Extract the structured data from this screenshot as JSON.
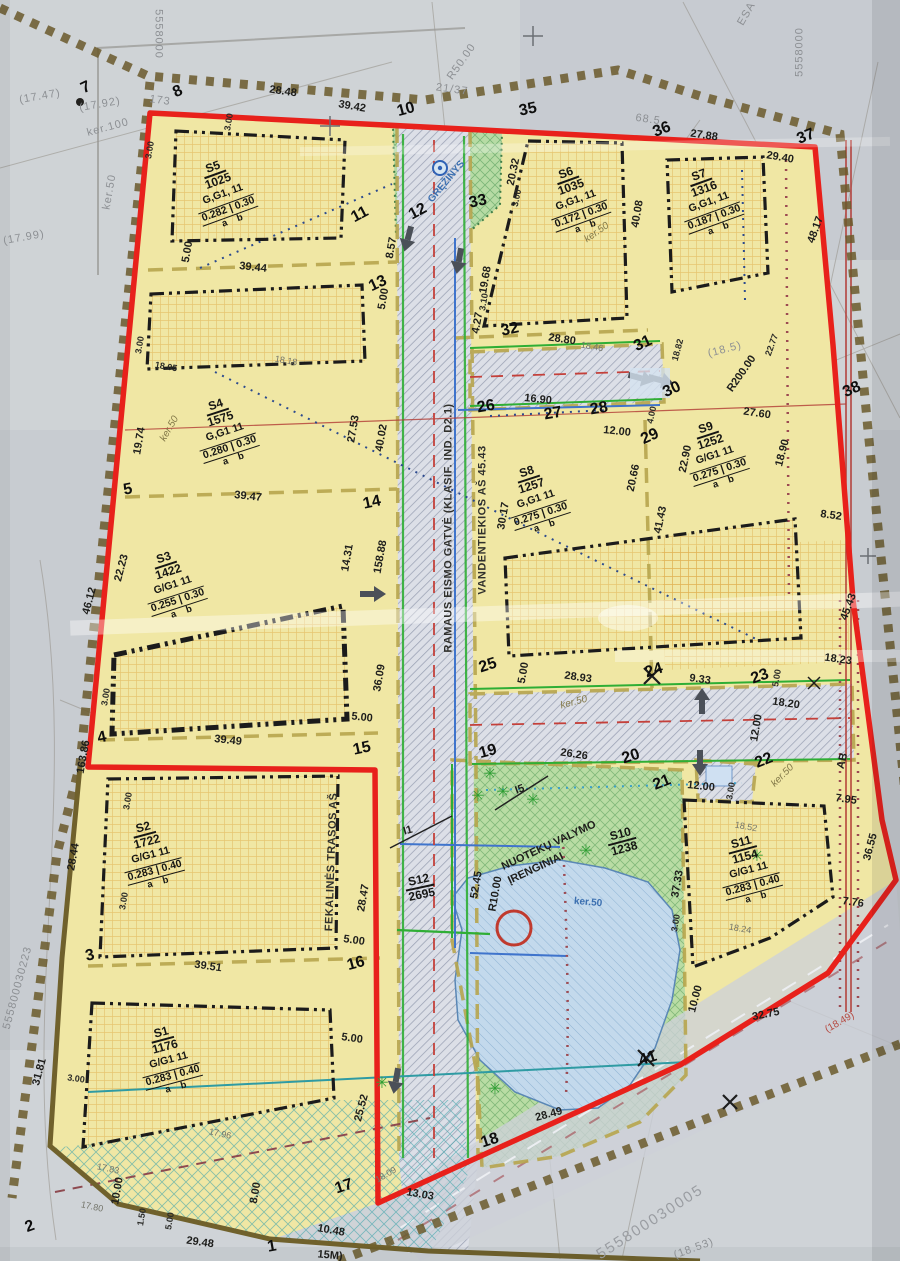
{
  "document": {
    "kind": "scanned cadastral detailed plan",
    "cadastral_numbers": [
      "555800030223",
      "555800030005"
    ],
    "grid_number": "5558000"
  },
  "colors": {
    "boundary_red": "#e8211b",
    "plot_yellow": "#f0e7a4",
    "green_zone": "#b6dba4",
    "road_gray": "#dcdfe7",
    "pond_blue": "#c3d9ec",
    "existing_boundary_brown": "#6b5a2c",
    "scan_gray_text": "#8d9094"
  },
  "plots": [
    {
      "code": "S5",
      "area": "1025",
      "use": "G,G1, 11",
      "ratio": "0.282 | 0.30",
      "ab": "a    b",
      "x": 222,
      "y": 192,
      "r": -20
    },
    {
      "code": "S6",
      "area": "1035",
      "use": "G,G1, 11",
      "ratio": "0.172 | 0.30",
      "ab": "a    b",
      "x": 575,
      "y": 198,
      "r": -20
    },
    {
      "code": "S7",
      "area": "1316",
      "use": "G,G1, 11",
      "ratio": "0.187 | 0.30",
      "ab": "a    b",
      "x": 708,
      "y": 200,
      "r": -20
    },
    {
      "code": "S4",
      "area": "1575",
      "use": "G,G1  11",
      "ratio": "0.280 | 0.30",
      "ab": "a    b",
      "x": 224,
      "y": 430,
      "r": -18
    },
    {
      "code": "S3",
      "area": "1422",
      "use": "G/G1  11",
      "ratio": "0.255 | 0.30",
      "ab": "a    b",
      "x": 172,
      "y": 583,
      "r": -18
    },
    {
      "code": "S8",
      "area": "1257",
      "use": "G,G1  11",
      "ratio": "0.275 | 0.30",
      "ab": "a    b",
      "x": 535,
      "y": 497,
      "r": -18
    },
    {
      "code": "S9",
      "area": "1252",
      "use": "G/G1  11",
      "ratio": "0.275 | 0.30",
      "ab": "a    b",
      "x": 714,
      "y": 453,
      "r": -18
    },
    {
      "code": "S2",
      "area": "1722",
      "use": "G/G1  11",
      "ratio": "0.283 | 0.40",
      "ab": "a    b",
      "x": 150,
      "y": 853,
      "r": -15
    },
    {
      "code": "S1",
      "area": "1176",
      "use": "G/G1  11",
      "ratio": "0.283 | 0.40",
      "ab": "a    b",
      "x": 168,
      "y": 1058,
      "r": -15
    },
    {
      "code": "S11",
      "area": "1154",
      "use": "G/G1  11",
      "ratio": "0.283 | 0.40",
      "ab": "a    b",
      "x": 748,
      "y": 868,
      "r": -15
    },
    {
      "code": "S10",
      "area": "1238",
      "x": 622,
      "y": 840,
      "r": -15
    },
    {
      "code": "S12",
      "area": "2695",
      "x": 420,
      "y": 886,
      "r": -12
    }
  ],
  "labels": [
    {
      "t": "28.48",
      "x": 283,
      "y": 92,
      "r": 8,
      "c": "d"
    },
    {
      "t": "39.42",
      "x": 352,
      "y": 107,
      "r": 10,
      "c": "d"
    },
    {
      "t": "21/37",
      "x": 452,
      "y": 90,
      "r": 8,
      "c": "g"
    },
    {
      "t": "7",
      "x": 86,
      "y": 88,
      "r": -25,
      "c": "p"
    },
    {
      "t": "8",
      "x": 178,
      "y": 92,
      "r": -25,
      "c": "p"
    },
    {
      "t": "173",
      "x": 160,
      "y": 101,
      "r": 8,
      "c": "g"
    },
    {
      "t": "10",
      "x": 406,
      "y": 110,
      "r": -15,
      "c": "p"
    },
    {
      "t": "35",
      "x": 528,
      "y": 110,
      "r": -12,
      "c": "p"
    },
    {
      "t": "36",
      "x": 662,
      "y": 130,
      "r": -22,
      "c": "p"
    },
    {
      "t": "27.88",
      "x": 704,
      "y": 136,
      "r": 8,
      "c": "d"
    },
    {
      "t": "37",
      "x": 806,
      "y": 137,
      "r": -22,
      "c": "p"
    },
    {
      "t": "29.40",
      "x": 780,
      "y": 158,
      "r": 10,
      "c": "d"
    },
    {
      "t": "68.5",
      "x": 648,
      "y": 120,
      "r": 8,
      "c": "g"
    },
    {
      "t": "R50.00",
      "x": 462,
      "y": 62,
      "r": -55,
      "c": "g"
    },
    {
      "t": "ESA",
      "x": 747,
      "y": 14,
      "r": -60,
      "c": "g"
    },
    {
      "t": "5558000",
      "x": 158,
      "y": 34,
      "r": 90,
      "c": "g"
    },
    {
      "t": "5558000",
      "x": 800,
      "y": 52,
      "r": -90,
      "c": "g"
    },
    {
      "t": "(17.47)",
      "x": 40,
      "y": 97,
      "r": -10,
      "c": "g"
    },
    {
      "t": "(17.92)",
      "x": 100,
      "y": 105,
      "r": -10,
      "c": "g"
    },
    {
      "t": "(17.99)",
      "x": 24,
      "y": 238,
      "r": -10,
      "c": "g"
    },
    {
      "t": "ker.100",
      "x": 108,
      "y": 128,
      "r": -15,
      "c": "g"
    },
    {
      "t": "ker.50",
      "x": 110,
      "y": 192,
      "r": -80,
      "c": "g"
    },
    {
      "t": "3.00",
      "x": 150,
      "y": 150,
      "r": -80,
      "c": "s"
    },
    {
      "t": "3.00",
      "x": 229,
      "y": 122,
      "r": -80,
      "c": "s"
    },
    {
      "t": "5.00",
      "x": 188,
      "y": 252,
      "r": -80,
      "c": "d"
    },
    {
      "t": "39.44",
      "x": 253,
      "y": 268,
      "r": 6,
      "c": "d"
    },
    {
      "t": "11",
      "x": 360,
      "y": 215,
      "r": -28,
      "c": "p"
    },
    {
      "t": "12",
      "x": 418,
      "y": 212,
      "r": -28,
      "c": "p"
    },
    {
      "t": "8.57",
      "x": 392,
      "y": 248,
      "r": -80,
      "c": "d"
    },
    {
      "t": "13",
      "x": 378,
      "y": 284,
      "r": -25,
      "c": "p"
    },
    {
      "t": "5.00",
      "x": 384,
      "y": 299,
      "r": -80,
      "c": "d"
    },
    {
      "t": "33",
      "x": 478,
      "y": 202,
      "r": -12,
      "c": "p"
    },
    {
      "t": "GRĘŽINYS",
      "x": 447,
      "y": 182,
      "r": -50,
      "c": "b"
    },
    {
      "t": "20.32",
      "x": 514,
      "y": 172,
      "r": -78,
      "c": "d"
    },
    {
      "t": "3.00",
      "x": 517,
      "y": 198,
      "r": -78,
      "c": "s"
    },
    {
      "t": "19.68",
      "x": 486,
      "y": 280,
      "r": -80,
      "c": "d"
    },
    {
      "t": "3.10",
      "x": 484,
      "y": 302,
      "r": -80,
      "c": "s"
    },
    {
      "t": "4.27",
      "x": 478,
      "y": 323,
      "r": -80,
      "c": "d"
    },
    {
      "t": "ker.50",
      "x": 597,
      "y": 233,
      "r": -35,
      "c": "k"
    },
    {
      "t": "40.08",
      "x": 638,
      "y": 214,
      "r": -80,
      "c": "d"
    },
    {
      "t": "48.17",
      "x": 816,
      "y": 230,
      "r": -70,
      "c": "d"
    },
    {
      "t": "32",
      "x": 510,
      "y": 330,
      "r": -12,
      "c": "p"
    },
    {
      "t": "28.80",
      "x": 562,
      "y": 340,
      "r": 8,
      "c": "d"
    },
    {
      "t": "18.46",
      "x": 592,
      "y": 347,
      "r": 10,
      "c": "h"
    },
    {
      "t": "31",
      "x": 643,
      "y": 344,
      "r": -25,
      "c": "p"
    },
    {
      "t": "18.82",
      "x": 678,
      "y": 350,
      "r": -75,
      "c": "s"
    },
    {
      "t": "22.77",
      "x": 772,
      "y": 345,
      "r": -70,
      "c": "s"
    },
    {
      "t": "(18.5)",
      "x": 725,
      "y": 350,
      "r": -15,
      "c": "g"
    },
    {
      "t": "R200.00",
      "x": 742,
      "y": 374,
      "r": -55,
      "c": "d"
    },
    {
      "t": "30",
      "x": 672,
      "y": 390,
      "r": -25,
      "c": "p"
    },
    {
      "t": "38",
      "x": 852,
      "y": 390,
      "r": -25,
      "c": "p"
    },
    {
      "t": "29",
      "x": 650,
      "y": 437,
      "r": -25,
      "c": "p"
    },
    {
      "t": "4.00",
      "x": 652,
      "y": 415,
      "r": -78,
      "c": "s"
    },
    {
      "t": "16.90",
      "x": 538,
      "y": 400,
      "r": 6,
      "c": "d"
    },
    {
      "t": "26",
      "x": 486,
      "y": 407,
      "r": -10,
      "c": "p"
    },
    {
      "t": "27",
      "x": 553,
      "y": 414,
      "r": -10,
      "c": "p"
    },
    {
      "t": "28",
      "x": 599,
      "y": 409,
      "r": -10,
      "c": "p"
    },
    {
      "t": "12.00",
      "x": 617,
      "y": 432,
      "r": 6,
      "c": "d"
    },
    {
      "t": "27.60",
      "x": 757,
      "y": 414,
      "r": 8,
      "c": "d"
    },
    {
      "t": "18.90",
      "x": 783,
      "y": 453,
      "r": -75,
      "c": "d"
    },
    {
      "t": "22.90",
      "x": 686,
      "y": 459,
      "r": -78,
      "c": "d"
    },
    {
      "t": "20.66",
      "x": 634,
      "y": 478,
      "r": -78,
      "c": "d"
    },
    {
      "t": "41.43",
      "x": 661,
      "y": 520,
      "r": -78,
      "c": "d"
    },
    {
      "t": "8.52",
      "x": 831,
      "y": 516,
      "r": 8,
      "c": "d"
    },
    {
      "t": "30.17",
      "x": 504,
      "y": 516,
      "r": -80,
      "c": "d"
    },
    {
      "t": "18.05",
      "x": 166,
      "y": 367,
      "r": 10,
      "c": "s"
    },
    {
      "t": "18.18",
      "x": 286,
      "y": 361,
      "r": 10,
      "c": "h"
    },
    {
      "t": "3.00",
      "x": 140,
      "y": 345,
      "r": -80,
      "c": "s"
    },
    {
      "t": "19.74",
      "x": 140,
      "y": 441,
      "r": -80,
      "c": "d"
    },
    {
      "t": "ker.50",
      "x": 170,
      "y": 429,
      "r": -60,
      "c": "k"
    },
    {
      "t": "27.53",
      "x": 354,
      "y": 429,
      "r": -80,
      "c": "d"
    },
    {
      "t": "40.02",
      "x": 382,
      "y": 438,
      "r": -80,
      "c": "d"
    },
    {
      "t": "39.47",
      "x": 248,
      "y": 497,
      "r": 6,
      "c": "d"
    },
    {
      "t": "5",
      "x": 128,
      "y": 490,
      "r": -10,
      "c": "p"
    },
    {
      "t": "14",
      "x": 372,
      "y": 503,
      "r": -12,
      "c": "p"
    },
    {
      "t": "46.12",
      "x": 90,
      "y": 601,
      "r": -75,
      "c": "d"
    },
    {
      "t": "22.23",
      "x": 122,
      "y": 568,
      "r": -75,
      "c": "d"
    },
    {
      "t": "14.31",
      "x": 348,
      "y": 558,
      "r": -80,
      "c": "d"
    },
    {
      "t": "158.88",
      "x": 381,
      "y": 557,
      "r": -80,
      "c": "d"
    },
    {
      "t": "36.09",
      "x": 380,
      "y": 678,
      "r": -80,
      "c": "d"
    },
    {
      "t": "5.00",
      "x": 362,
      "y": 718,
      "r": 6,
      "c": "d"
    },
    {
      "t": "39.49",
      "x": 228,
      "y": 741,
      "r": 6,
      "c": "d"
    },
    {
      "t": "4",
      "x": 102,
      "y": 738,
      "r": -12,
      "c": "p"
    },
    {
      "t": "15",
      "x": 362,
      "y": 749,
      "r": -12,
      "c": "p"
    },
    {
      "t": "3.00",
      "x": 106,
      "y": 697,
      "r": -80,
      "c": "s"
    },
    {
      "t": "163.86",
      "x": 84,
      "y": 757,
      "r": -80,
      "c": "d"
    },
    {
      "t": "25",
      "x": 488,
      "y": 666,
      "r": -18,
      "c": "p"
    },
    {
      "t": "5.00",
      "x": 524,
      "y": 673,
      "r": -80,
      "c": "d"
    },
    {
      "t": "28.93",
      "x": 578,
      "y": 678,
      "r": 8,
      "c": "d"
    },
    {
      "t": "24",
      "x": 654,
      "y": 671,
      "r": -18,
      "c": "p"
    },
    {
      "t": "9.33",
      "x": 700,
      "y": 680,
      "r": 8,
      "c": "d"
    },
    {
      "t": "23",
      "x": 760,
      "y": 677,
      "r": -20,
      "c": "p"
    },
    {
      "t": "5.00",
      "x": 777,
      "y": 678,
      "r": -80,
      "c": "s"
    },
    {
      "t": "18.23",
      "x": 838,
      "y": 660,
      "r": 8,
      "c": "d"
    },
    {
      "t": "ker.50",
      "x": 574,
      "y": 703,
      "r": -15,
      "c": "k"
    },
    {
      "t": "18.20",
      "x": 786,
      "y": 704,
      "r": 8,
      "c": "d"
    },
    {
      "t": "12.00",
      "x": 757,
      "y": 728,
      "r": -80,
      "c": "d"
    },
    {
      "t": "22",
      "x": 764,
      "y": 761,
      "r": -22,
      "c": "p"
    },
    {
      "t": "ker.50",
      "x": 783,
      "y": 776,
      "r": -45,
      "c": "k"
    },
    {
      "t": "AB",
      "x": 843,
      "y": 761,
      "r": -75,
      "c": "d"
    },
    {
      "t": "45.43",
      "x": 849,
      "y": 607,
      "r": -70,
      "c": "d"
    },
    {
      "t": "7.95",
      "x": 846,
      "y": 800,
      "r": 8,
      "c": "d"
    },
    {
      "t": "36.55",
      "x": 871,
      "y": 847,
      "r": -75,
      "c": "d"
    },
    {
      "t": "7.76",
      "x": 853,
      "y": 903,
      "r": 8,
      "c": "d"
    },
    {
      "t": "26.26",
      "x": 574,
      "y": 755,
      "r": 8,
      "c": "d"
    },
    {
      "t": "19",
      "x": 488,
      "y": 752,
      "r": -15,
      "c": "p"
    },
    {
      "t": "20",
      "x": 631,
      "y": 757,
      "r": -18,
      "c": "p"
    },
    {
      "t": "21",
      "x": 662,
      "y": 783,
      "r": -22,
      "c": "p"
    },
    {
      "t": "12.00",
      "x": 701,
      "y": 787,
      "r": 6,
      "c": "d"
    },
    {
      "t": "3.00",
      "x": 731,
      "y": 791,
      "r": -80,
      "c": "s"
    },
    {
      "t": "18.52",
      "x": 746,
      "y": 827,
      "r": 10,
      "c": "h"
    },
    {
      "t": "37.33",
      "x": 678,
      "y": 884,
      "r": -80,
      "c": "d"
    },
    {
      "t": "18.24",
      "x": 740,
      "y": 929,
      "r": 10,
      "c": "h"
    },
    {
      "t": "3.00",
      "x": 676,
      "y": 923,
      "r": -80,
      "c": "s"
    },
    {
      "t": "I5",
      "x": 520,
      "y": 790,
      "r": -20,
      "c": "d"
    },
    {
      "t": "I1",
      "x": 408,
      "y": 831,
      "r": -15,
      "c": "d"
    },
    {
      "t": "52.45",
      "x": 477,
      "y": 885,
      "r": -80,
      "c": "d"
    },
    {
      "t": "R10.00",
      "x": 496,
      "y": 894,
      "r": -80,
      "c": "d"
    },
    {
      "t": "NUOTEKŲ VALYMO",
      "x": 549,
      "y": 846,
      "r": -25,
      "c": "d"
    },
    {
      "t": "ĮRENGINIAI",
      "x": 536,
      "y": 869,
      "r": -25,
      "c": "d"
    },
    {
      "t": "ker.50",
      "x": 588,
      "y": 903,
      "r": 5,
      "c": "b"
    },
    {
      "t": "28.47",
      "x": 364,
      "y": 898,
      "r": -80,
      "c": "d"
    },
    {
      "t": "5.00",
      "x": 354,
      "y": 941,
      "r": 8,
      "c": "d"
    },
    {
      "t": "16",
      "x": 356,
      "y": 964,
      "r": -15,
      "c": "p"
    },
    {
      "t": "39.51",
      "x": 208,
      "y": 967,
      "r": 8,
      "c": "d"
    },
    {
      "t": "3",
      "x": 90,
      "y": 956,
      "r": -12,
      "c": "p"
    },
    {
      "t": "3.00",
      "x": 124,
      "y": 901,
      "r": -80,
      "c": "s"
    },
    {
      "t": "3.00",
      "x": 128,
      "y": 801,
      "r": -80,
      "c": "s"
    },
    {
      "t": "28.44",
      "x": 74,
      "y": 857,
      "r": -80,
      "c": "d"
    },
    {
      "t": "31.81",
      "x": 40,
      "y": 1072,
      "r": -75,
      "c": "d"
    },
    {
      "t": "555800030223",
      "x": 18,
      "y": 988,
      "r": -75,
      "c": "g"
    },
    {
      "t": "3.00",
      "x": 76,
      "y": 1079,
      "r": 8,
      "c": "s"
    },
    {
      "t": "5.00",
      "x": 352,
      "y": 1039,
      "r": 8,
      "c": "d"
    },
    {
      "t": "25.52",
      "x": 362,
      "y": 1108,
      "r": -75,
      "c": "d"
    },
    {
      "t": "17.96",
      "x": 220,
      "y": 1134,
      "r": 12,
      "c": "h"
    },
    {
      "t": "17.83",
      "x": 108,
      "y": 1169,
      "r": 12,
      "c": "h"
    },
    {
      "t": "17.80",
      "x": 92,
      "y": 1207,
      "r": 12,
      "c": "h"
    },
    {
      "t": "10.00",
      "x": 118,
      "y": 1191,
      "r": -80,
      "c": "d"
    },
    {
      "t": "1.50",
      "x": 142,
      "y": 1217,
      "r": -80,
      "c": "s"
    },
    {
      "t": "5.00",
      "x": 170,
      "y": 1221,
      "r": -80,
      "c": "s"
    },
    {
      "t": "8.00",
      "x": 256,
      "y": 1193,
      "r": -80,
      "c": "d"
    },
    {
      "t": "29.48",
      "x": 200,
      "y": 1243,
      "r": 8,
      "c": "d"
    },
    {
      "t": "1",
      "x": 272,
      "y": 1247,
      "r": -10,
      "c": "p"
    },
    {
      "t": "10.48",
      "x": 331,
      "y": 1231,
      "r": 10,
      "c": "d"
    },
    {
      "t": "13.03",
      "x": 420,
      "y": 1195,
      "r": 10,
      "c": "d"
    },
    {
      "t": "2",
      "x": 30,
      "y": 1227,
      "r": -20,
      "c": "p"
    },
    {
      "t": "18",
      "x": 490,
      "y": 1141,
      "r": -18,
      "c": "p"
    },
    {
      "t": "28.49",
      "x": 549,
      "y": 1115,
      "r": -15,
      "c": "d"
    },
    {
      "t": "41",
      "x": 648,
      "y": 1059,
      "r": -18,
      "c": "p"
    },
    {
      "t": "17",
      "x": 344,
      "y": 1187,
      "r": -18,
      "c": "p"
    },
    {
      "t": "18.09",
      "x": 386,
      "y": 1175,
      "r": -30,
      "c": "h"
    },
    {
      "t": "(18.49)",
      "x": 840,
      "y": 1023,
      "r": -30,
      "c": "r"
    },
    {
      "t": "32.75",
      "x": 766,
      "y": 1015,
      "r": -12,
      "c": "d"
    },
    {
      "t": "10.00",
      "x": 696,
      "y": 999,
      "r": -75,
      "c": "d"
    },
    {
      "t": "555800030005",
      "x": 650,
      "y": 1222,
      "r": -33,
      "c": "G"
    },
    {
      "t": "(18.53)",
      "x": 694,
      "y": 1249,
      "r": -20,
      "c": "g"
    },
    {
      "t": "15M)",
      "x": 330,
      "y": 1256,
      "r": 5,
      "c": "d"
    },
    {
      "t": "RAMAUS EISMO GATVĖ (KLASIF. IND. D2.1)",
      "x": 449,
      "y": 528,
      "r": -90,
      "c": "v"
    },
    {
      "t": "VANDENTIEKIOS AŠ 45.43",
      "x": 483,
      "y": 520,
      "r": -90,
      "c": "v"
    },
    {
      "t": "FEKALINĖS TRASOS AŠ",
      "x": 332,
      "y": 862,
      "r": -88,
      "c": "v"
    },
    {
      "t": "✳",
      "x": 490,
      "y": 775,
      "r": 0,
      "c": "t"
    },
    {
      "t": "✳",
      "x": 503,
      "y": 793,
      "r": 0,
      "c": "t"
    },
    {
      "t": "✳",
      "x": 478,
      "y": 797,
      "r": 0,
      "c": "t"
    },
    {
      "t": "✳",
      "x": 533,
      "y": 801,
      "r": 0,
      "c": "t"
    },
    {
      "t": "✳",
      "x": 586,
      "y": 852,
      "r": 0,
      "c": "t"
    },
    {
      "t": "✳",
      "x": 757,
      "y": 857,
      "r": 0,
      "c": "t"
    },
    {
      "t": "✳",
      "x": 495,
      "y": 1090,
      "r": 0,
      "c": "t"
    },
    {
      "t": "✳",
      "x": 382,
      "y": 1084,
      "r": 0,
      "c": "t"
    }
  ]
}
